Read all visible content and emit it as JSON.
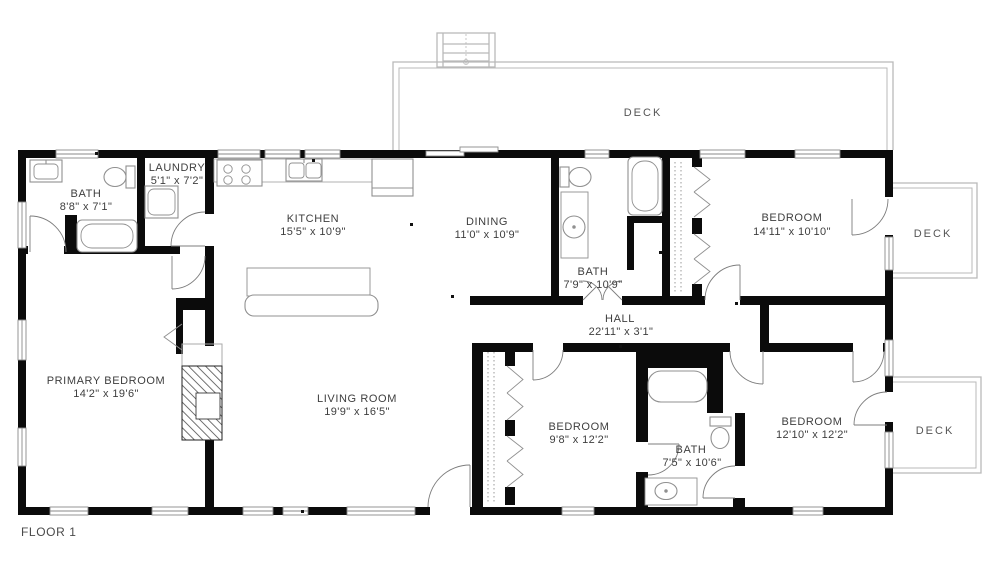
{
  "floor_label": "FLOOR 1",
  "colors": {
    "wall": "#0b0b0b",
    "fixture_stroke": "#909090",
    "deck_stroke": "#b9b9b9",
    "text": "#3e3e3e",
    "background": "#ffffff"
  },
  "rooms": [
    {
      "id": "bath-1",
      "name": "BATH",
      "dims": "8'8\" x 7'1\""
    },
    {
      "id": "laundry",
      "name": "LAUNDRY",
      "dims": "5'1\" x 7'2\""
    },
    {
      "id": "kitchen",
      "name": "KITCHEN",
      "dims": "15'5\" x 10'9\""
    },
    {
      "id": "dining",
      "name": "DINING",
      "dims": "11'0\" x 10'9\""
    },
    {
      "id": "bath-2",
      "name": "BATH",
      "dims": "7'9\" x 10'9\""
    },
    {
      "id": "bedroom-1",
      "name": "BEDROOM",
      "dims": "14'11\" x 10'10\""
    },
    {
      "id": "hall",
      "name": "HALL",
      "dims": "22'11\" x 3'1\""
    },
    {
      "id": "primary-bedroom",
      "name": "PRIMARY BEDROOM",
      "dims": "14'2\" x 19'6\""
    },
    {
      "id": "living-room",
      "name": "LIVING ROOM",
      "dims": "19'9\" x 16'5\""
    },
    {
      "id": "bedroom-2",
      "name": "BEDROOM",
      "dims": "9'8\" x 12'2\""
    },
    {
      "id": "bath-3",
      "name": "BATH",
      "dims": "7'5\" x 10'6\""
    },
    {
      "id": "bedroom-3",
      "name": "BEDROOM",
      "dims": "12'10\" x 12'2\""
    }
  ],
  "decks": [
    {
      "id": "deck-top",
      "label": "DECK"
    },
    {
      "id": "deck-right-upper",
      "label": "DECK"
    },
    {
      "id": "deck-right-lower",
      "label": "DECK"
    }
  ]
}
